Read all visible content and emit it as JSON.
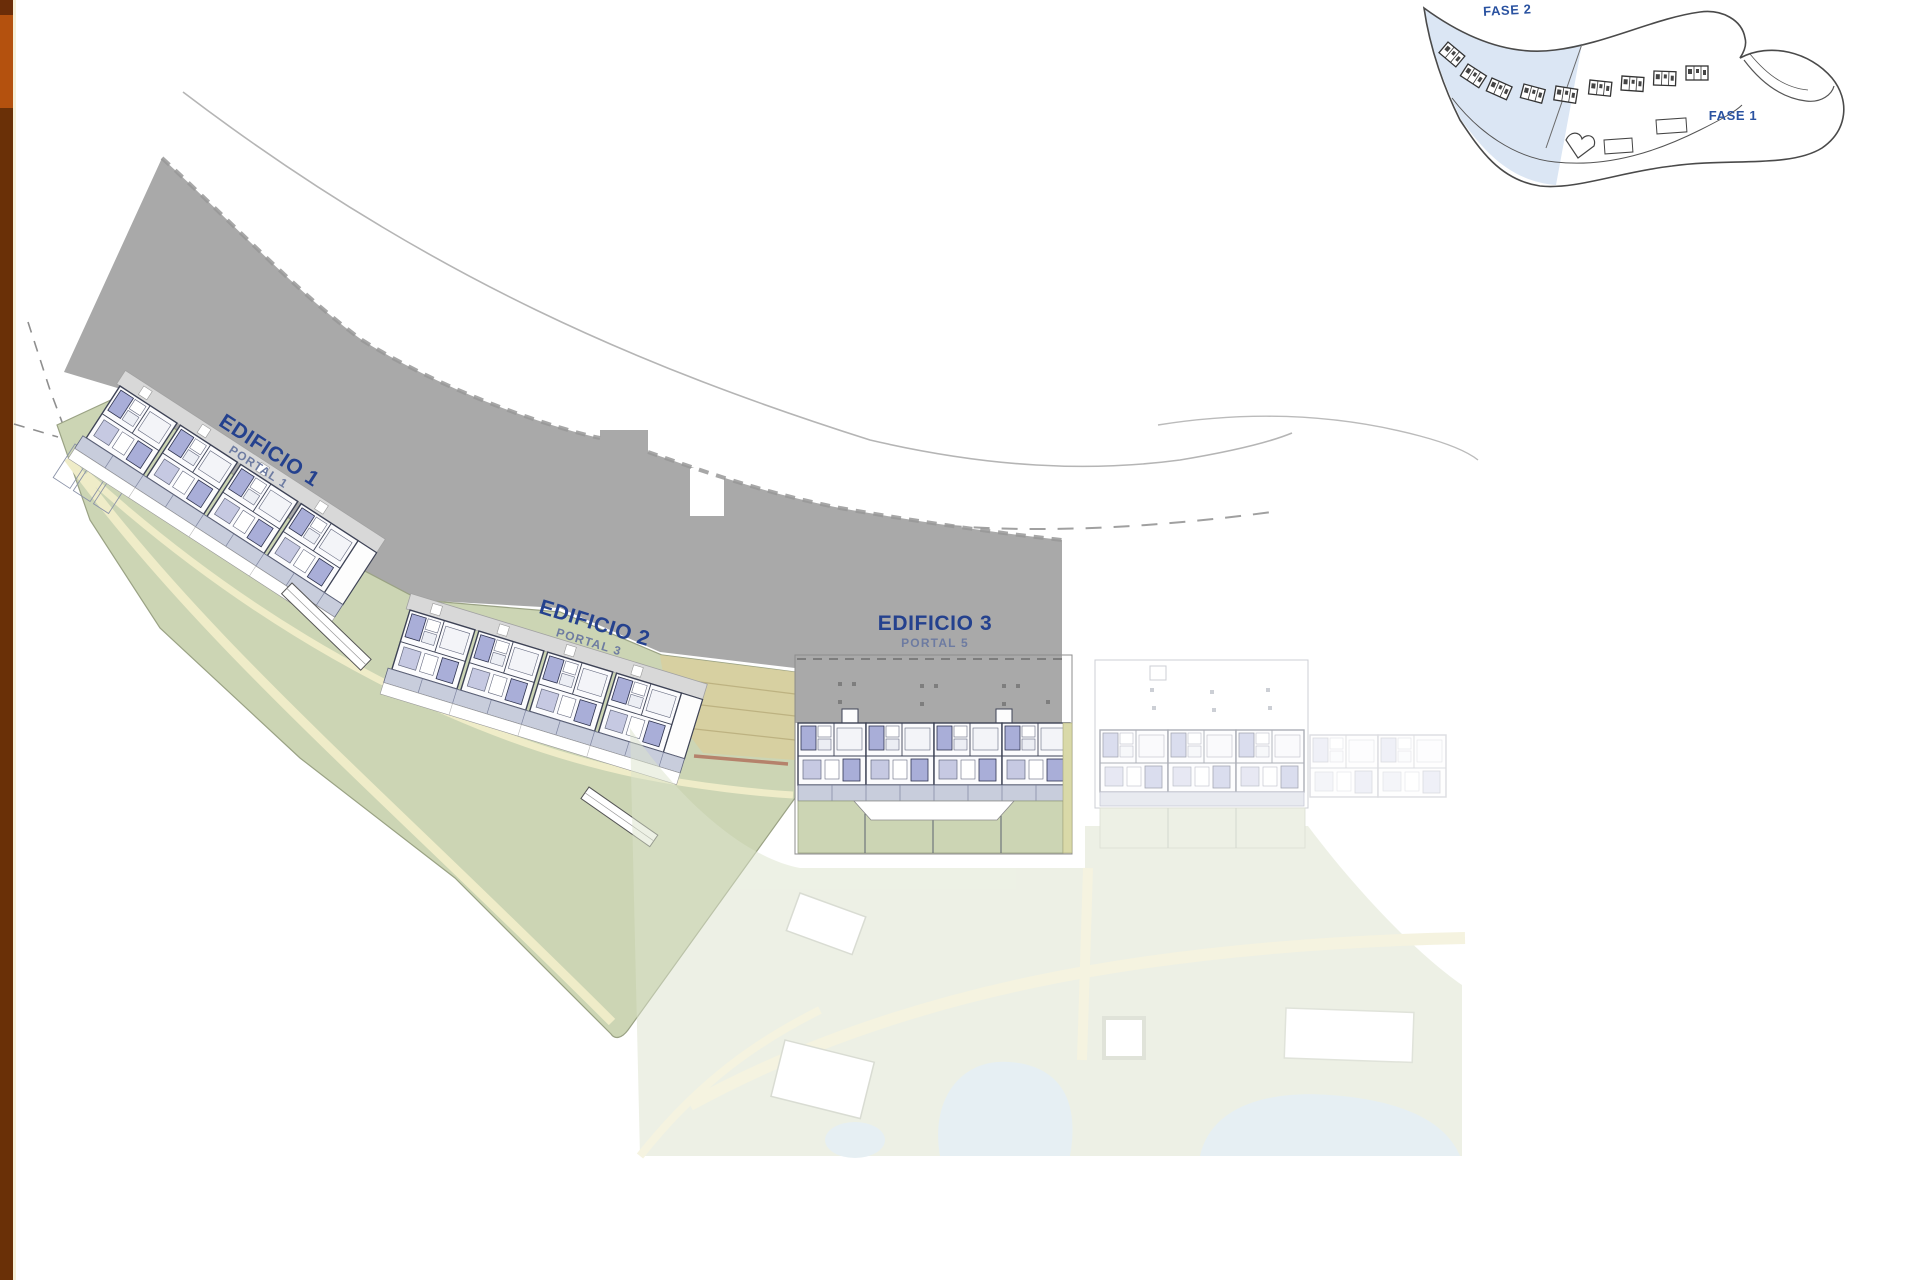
{
  "plan": {
    "buildings": [
      {
        "id": "building-1",
        "label": "EDIFICIO 1",
        "portal": "PORTAL 1"
      },
      {
        "id": "building-2",
        "label": "EDIFICIO 2",
        "portal": "PORTAL 3"
      },
      {
        "id": "building-3",
        "label": "EDIFICIO 3",
        "portal": "PORTAL 5"
      }
    ]
  },
  "inset_map": {
    "fase2_label": "FASE 2",
    "fase1_label": "FASE 1"
  },
  "colors": {
    "parcel_gray": "#a9a9a9",
    "landscape_green": "#ccd5b4",
    "path_cream": "#efecc8",
    "room_lavender": "#a9aed8",
    "room_lavender_light": "#c6c9e2",
    "corridor_blue_gray": "#c8cddc",
    "building_line": "#3e4356",
    "label_blue": "#24418e",
    "portal_gray_blue": "#6d7ba1",
    "inset_phase2_blue": "#dbe6f4",
    "pool_blue": "#cfe0e8",
    "faded_landscape": "#e3e8d6",
    "terrace_tan": "#d8cf9f",
    "sidebar_orange": "#b4510e",
    "sidebar_brown": "#6a3007",
    "sidebar_dark_top": "#6b2d08"
  }
}
